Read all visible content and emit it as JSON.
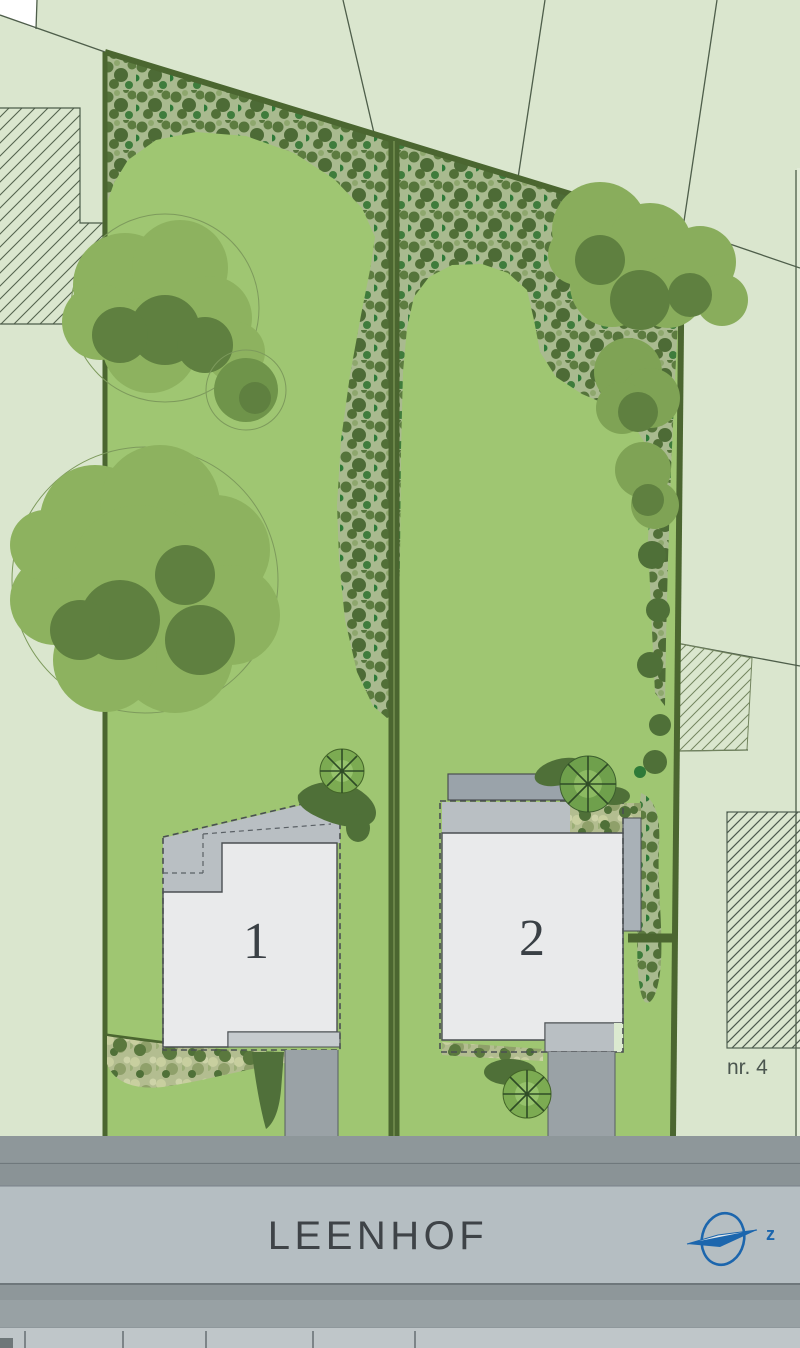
{
  "plan": {
    "street_name": "LEENHOF",
    "plots": [
      {
        "number": "1"
      },
      {
        "number": "2"
      }
    ],
    "neighbor_label": "nr. 4",
    "compass": {
      "letter": "z"
    }
  },
  "icons": {
    "north_arrow": "compass-needle-in-ellipse"
  },
  "colors": {
    "background": "#dae6ce",
    "lawn": "#9fc672",
    "shrub_base": "#a9ba8f",
    "shrub_dark": "#55743b",
    "hedge": "#4b6630",
    "tree_light": "#8db25f",
    "tree_dark": "#5f8040",
    "building_light": "#e9eaeb",
    "building_mid": "#b9bfc3",
    "building_dark": "#9aa3aa",
    "road": "#b5bec2",
    "verge": "#8e979a",
    "outline": "#4a4f52",
    "compass_blue": "#1c66ad",
    "street_text": "#3e4347"
  }
}
